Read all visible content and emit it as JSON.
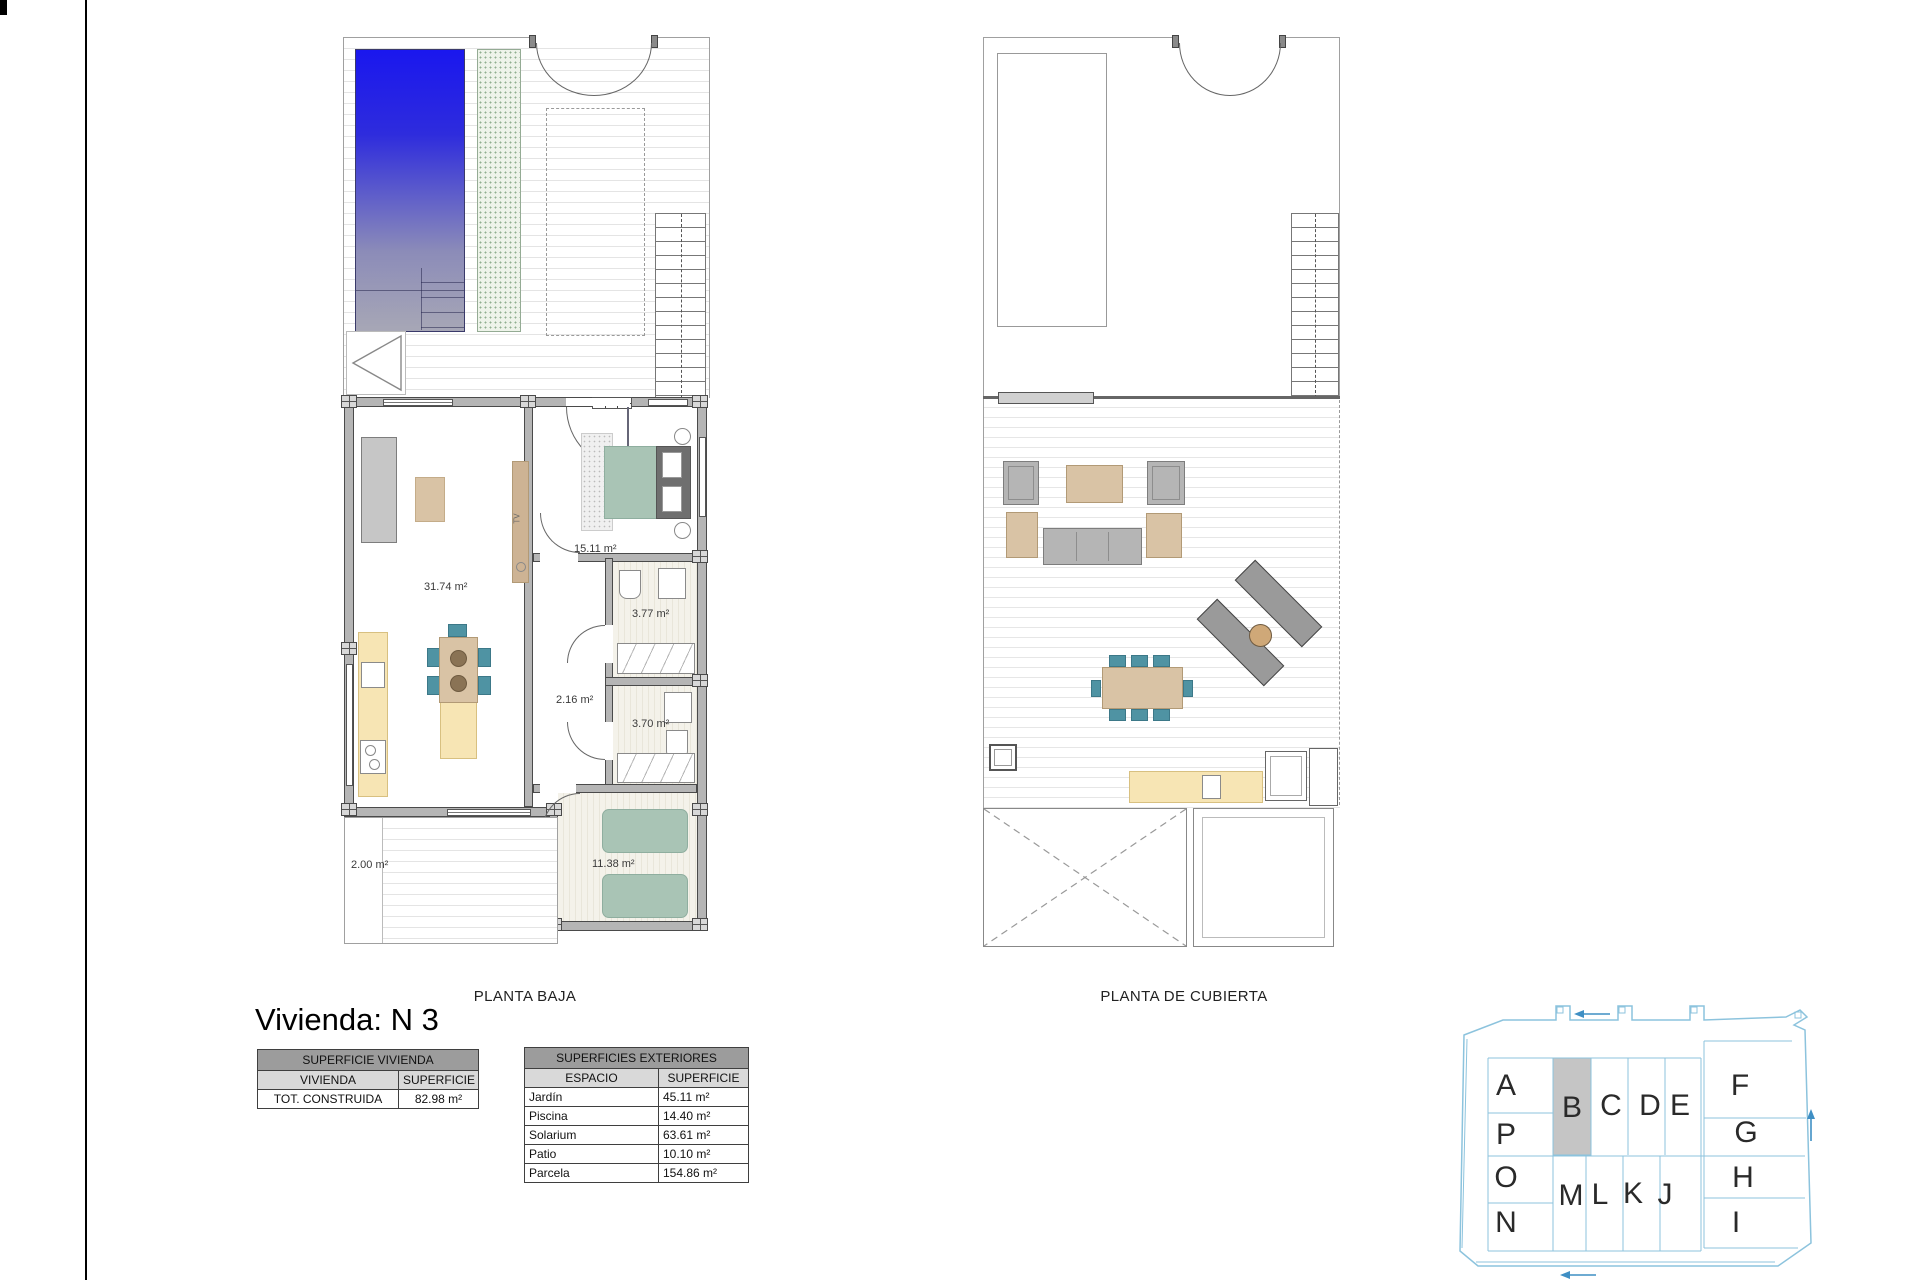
{
  "title": "Vivienda: N 3",
  "left_plan": {
    "caption": "PLANTA BAJA",
    "rooms": {
      "living": "31.74 m²",
      "bedroom_main": "15.11 m²",
      "bath_top": "3.77 m²",
      "hall": "2.16 m²",
      "bath_bottom": "3.70 m²",
      "bedroom_second": "11.38 m²",
      "patio": "2.00 m²"
    },
    "tv_label": "TV"
  },
  "right_plan": {
    "caption": "PLANTA DE CUBIERTA"
  },
  "surface_table": {
    "title": "SUPERFICIE VIVIENDA",
    "col_space": "VIVIENDA",
    "col_area": "SUPERFICIE",
    "rows": [
      {
        "space": "TOT. CONSTRUIDA",
        "area": "82.98 m²"
      }
    ]
  },
  "exterior_table": {
    "title": "SUPERFICIES EXTERIORES",
    "col_space": "ESPACIO",
    "col_area": "SUPERFICIE",
    "rows": [
      {
        "space": "Jardín",
        "area": "45.11 m²"
      },
      {
        "space": "Piscina",
        "area": "14.40 m²"
      },
      {
        "space": "Solarium",
        "area": "63.61 m²"
      },
      {
        "space": "Patio",
        "area": "10.10 m²"
      },
      {
        "space": "Parcela",
        "area": "154.86 m²"
      }
    ]
  },
  "site_key": {
    "highlighted_unit": "B",
    "units": [
      "A",
      "P",
      "O",
      "N",
      "B",
      "C",
      "D",
      "E",
      "F",
      "G",
      "H",
      "I",
      "M",
      "L",
      "K",
      "J"
    ]
  },
  "colors": {
    "pool_top": "#1a17ee",
    "pool_bottom": "#a7a7b6",
    "vegetation": "#eef4ea",
    "wall": "#b5b5b5",
    "furn_gray": "#b5b5b5",
    "tan": "#d9c3a5",
    "teal": "#4f93a3",
    "sage": "#a9c4b5",
    "cream": "#f7e5b4",
    "hdr_gray": "#9c9c9c",
    "sub_gray": "#d9d9d9",
    "key_blue": "#8cc3dd",
    "key_arrow": "#3f8fc4",
    "key_fill": "#c5c5c5"
  }
}
